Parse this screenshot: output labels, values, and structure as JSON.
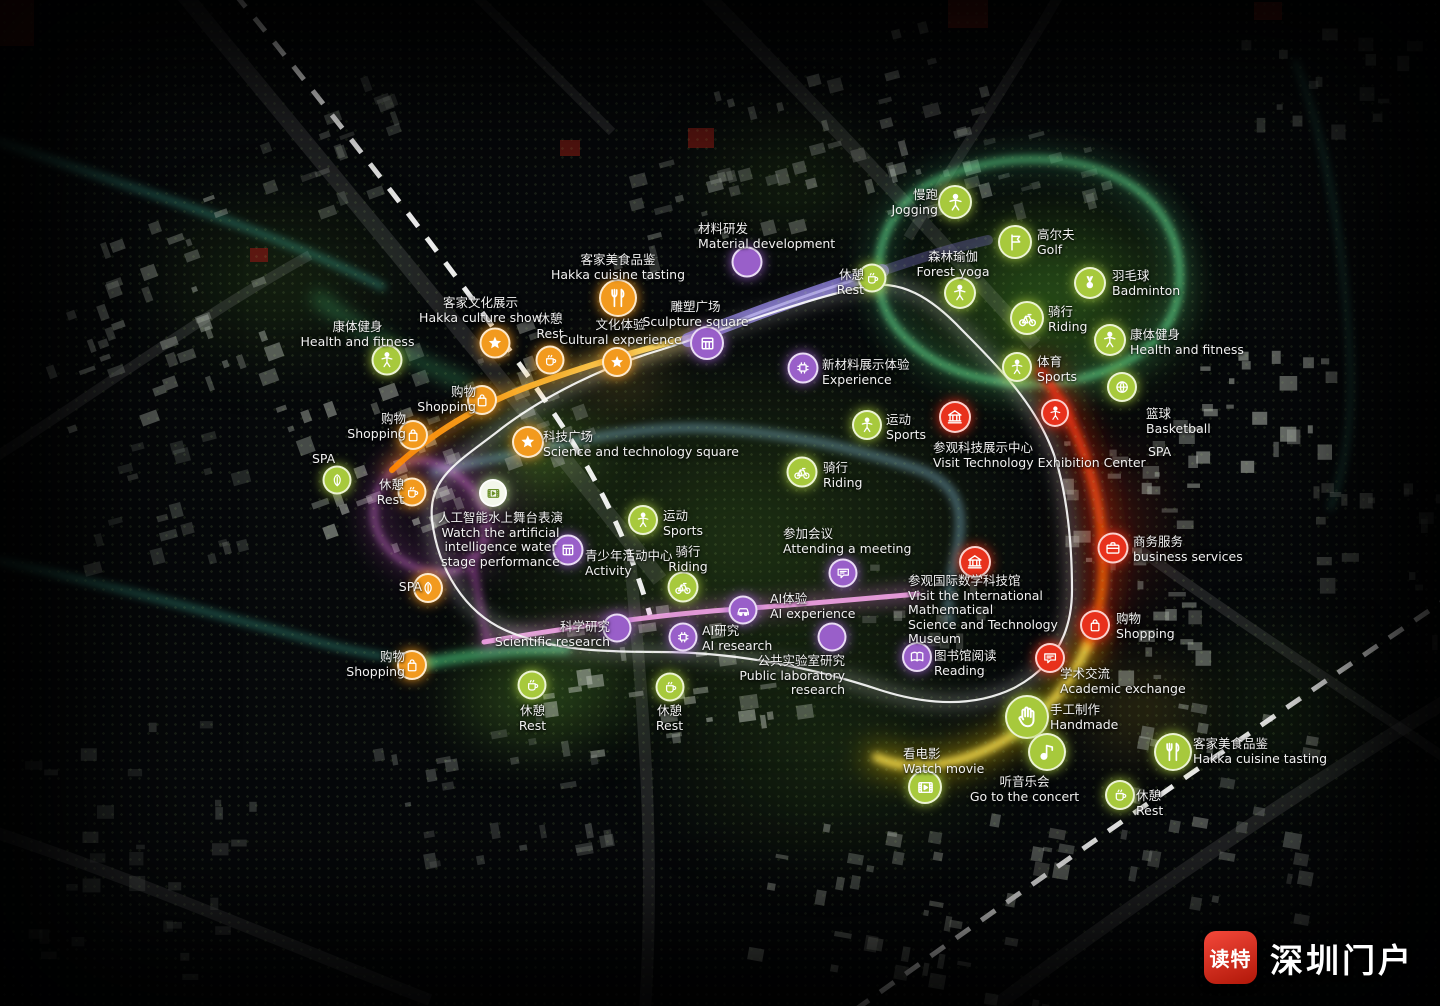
{
  "watermark": {
    "app_name": "读特",
    "site_name": "深圳门户"
  },
  "colors": {
    "green": "#a7c93c",
    "orange": "#f29a1e",
    "purple": "#995fc9",
    "red": "#e8311c",
    "white": "#f3f7ea"
  },
  "points": [
    {
      "name": "jogging",
      "zh": "慢跑",
      "en": "Jogging",
      "icon": "person",
      "c": "g",
      "x": 955,
      "y": 202,
      "s": 30,
      "lx": 862,
      "ly": 188,
      "lw": 76,
      "ta": "right"
    },
    {
      "name": "golf",
      "zh": "高尔夫",
      "en": "Golf",
      "icon": "flag",
      "c": "g",
      "x": 1015,
      "y": 242,
      "s": 30,
      "lx": 1037,
      "ly": 228,
      "lw": 90,
      "ta": "left"
    },
    {
      "name": "forest-yoga",
      "zh": "森林瑜伽",
      "en": "Forest yoga",
      "icon": "person",
      "c": "g",
      "x": 960,
      "y": 293,
      "s": 28,
      "lx": 898,
      "ly": 250,
      "lw": 110,
      "ta": "center"
    },
    {
      "name": "badminton",
      "zh": "羽毛球",
      "en": "Badminton",
      "icon": "shuttle",
      "c": "g",
      "x": 1090,
      "y": 283,
      "s": 28,
      "lx": 1112,
      "ly": 269,
      "lw": 95,
      "ta": "left"
    },
    {
      "name": "riding-north",
      "zh": "骑行",
      "en": "Riding",
      "icon": "bike",
      "c": "g",
      "x": 1027,
      "y": 318,
      "s": 30,
      "lx": 1048,
      "ly": 305,
      "lw": 70,
      "ta": "left"
    },
    {
      "name": "health-fitness-east",
      "zh": "康体健身",
      "en": "Health and fitness",
      "icon": "person",
      "c": "g",
      "x": 1110,
      "y": 340,
      "s": 28,
      "lx": 1130,
      "ly": 328,
      "lw": 125,
      "ta": "left"
    },
    {
      "name": "sports-east",
      "zh": "体育",
      "en": "Sports",
      "icon": "person",
      "c": "g",
      "x": 1017,
      "y": 367,
      "s": 26,
      "lx": 1037,
      "ly": 355,
      "lw": 60,
      "ta": "left"
    },
    {
      "name": "basketball",
      "zh": "篮球",
      "en": "Basketball",
      "icon": "ball",
      "c": "g",
      "x": 1122,
      "y": 387,
      "s": 26,
      "lx": 1146,
      "ly": 407,
      "lw": 80,
      "ta": "left"
    },
    {
      "name": "spa-east",
      "en": "SPA",
      "c": "g",
      "x": 1157,
      "y": 452,
      "lx": 1148,
      "ly": 445,
      "lw": 45,
      "ta": "left"
    },
    {
      "name": "health-fitness-west",
      "zh": "康体健身",
      "en": "Health and fitness",
      "icon": "person",
      "c": "g",
      "x": 387,
      "y": 360,
      "s": 27,
      "lx": 300,
      "ly": 320,
      "lw": 115,
      "ta": "center"
    },
    {
      "name": "shopping-nw1",
      "zh": "购物",
      "en": "Shopping",
      "icon": "bag",
      "c": "o",
      "x": 482,
      "y": 400,
      "s": 26,
      "lx": 398,
      "ly": 385,
      "lw": 78,
      "ta": "right"
    },
    {
      "name": "shopping-nw2",
      "zh": "购物",
      "en": "Shopping",
      "icon": "bag",
      "c": "o",
      "x": 413,
      "y": 435,
      "s": 26,
      "lx": 328,
      "ly": 412,
      "lw": 78,
      "ta": "right"
    },
    {
      "name": "spa-west",
      "en": "SPA",
      "icon": "leaf",
      "c": "g",
      "x": 337,
      "y": 480,
      "s": 25,
      "lx": 312,
      "ly": 452,
      "lw": 45,
      "ta": "left"
    },
    {
      "name": "rest-west",
      "zh": "休憩",
      "en": "Rest",
      "icon": "cup",
      "c": "o",
      "x": 412,
      "y": 492,
      "s": 25,
      "lx": 352,
      "ly": 478,
      "lw": 52,
      "ta": "right"
    },
    {
      "name": "rest-nw",
      "zh": "休憩",
      "en": "Rest",
      "icon": "cup",
      "c": "o",
      "x": 550,
      "y": 360,
      "s": 25,
      "lx": 524,
      "ly": 312,
      "lw": 52,
      "ta": "center"
    },
    {
      "name": "hakka-cuisine-west",
      "zh": "客家美食品鉴",
      "en": "Hakka cuisine tasting",
      "icon": "fork",
      "c": "o",
      "x": 618,
      "y": 298,
      "s": 34,
      "lx": 518,
      "ly": 253,
      "lw": 200,
      "ta": "center"
    },
    {
      "name": "hakka-culture-show",
      "zh": "客家文化展示",
      "en": "Hakka culture show",
      "icon": "star",
      "c": "o",
      "x": 495,
      "y": 343,
      "s": 27,
      "lx": 398,
      "ly": 296,
      "lw": 165,
      "ta": "center"
    },
    {
      "name": "cultural-experience",
      "zh": "文化体验",
      "en": "Cultural experience",
      "icon": "star",
      "c": "o",
      "x": 617,
      "y": 362,
      "s": 26,
      "lx": 548,
      "ly": 318,
      "lw": 145,
      "ta": "center"
    },
    {
      "name": "sculpture-square",
      "zh": "雕塑广场",
      "en": "Sculpture square",
      "icon": "grid",
      "c": "p",
      "x": 707,
      "y": 343,
      "s": 30,
      "lx": 628,
      "ly": 300,
      "lw": 135,
      "ta": "center"
    },
    {
      "name": "material-development",
      "zh": "材料研发",
      "en": "Material development",
      "icon": "flask",
      "c": "p",
      "x": 747,
      "y": 262,
      "s": 27,
      "lx": 698,
      "ly": 222,
      "lw": 165,
      "ta": "left"
    },
    {
      "name": "rest-north",
      "zh": "休憩",
      "en": "Rest",
      "icon": "cup",
      "c": "g",
      "x": 872,
      "y": 278,
      "s": 25,
      "lx": 812,
      "ly": 268,
      "lw": 52,
      "ta": "right"
    },
    {
      "name": "experience-new-materials",
      "zh": "新材料展示体验",
      "en": "Experience",
      "icon": "chip",
      "c": "p",
      "x": 803,
      "y": 368,
      "s": 27,
      "lx": 822,
      "ly": 358,
      "lw": 130,
      "ta": "left"
    },
    {
      "name": "sports-mid-east",
      "zh": "运动",
      "en": "Sports",
      "icon": "person",
      "c": "g",
      "x": 867,
      "y": 425,
      "s": 26,
      "lx": 886,
      "ly": 413,
      "lw": 60,
      "ta": "left"
    },
    {
      "name": "riding-mid-east",
      "zh": "骑行",
      "en": "Riding",
      "icon": "bike",
      "c": "g",
      "x": 802,
      "y": 472,
      "s": 27,
      "lx": 823,
      "ly": 461,
      "lw": 60,
      "ta": "left"
    },
    {
      "name": "sci-tech-square",
      "zh": "科技广场",
      "en": "Science and technology square",
      "icon": "star",
      "c": "o",
      "x": 528,
      "y": 442,
      "s": 28,
      "lx": 543,
      "ly": 430,
      "lw": 215,
      "ta": "left"
    },
    {
      "name": "visit-tech-exhibition-center",
      "zh": "参观科技展示中心",
      "en": "Visit Technology Exhibition Center",
      "icon": "bank",
      "c": "r",
      "x": 955,
      "y": 417,
      "s": 28,
      "lx": 933,
      "ly": 441,
      "lw": 235,
      "ta": "left"
    },
    {
      "name": "tech-route-stop",
      "icon": "person",
      "c": "r",
      "x": 1055,
      "y": 413,
      "s": 24
    },
    {
      "name": "ai-water-stage-show",
      "zh": "人工智能水上舞台表演",
      "en": "Watch the artificial intelligence water",
      "en2": "stage performance",
      "icon": "film",
      "c": "wh",
      "x": 493,
      "y": 493,
      "s": 24,
      "lx": 408,
      "ly": 511,
      "lw": 185,
      "ta": "center"
    },
    {
      "name": "youth-activity-center",
      "zh": "青少年活动中心",
      "en": "Activity",
      "icon": "grid",
      "c": "p",
      "x": 568,
      "y": 550,
      "s": 27,
      "lx": 585,
      "ly": 549,
      "lw": 130,
      "ta": "left"
    },
    {
      "name": "sports-center",
      "zh": "运动",
      "en": "Sports",
      "icon": "person",
      "c": "g",
      "x": 643,
      "y": 520,
      "s": 26,
      "lx": 663,
      "ly": 509,
      "lw": 60,
      "ta": "left"
    },
    {
      "name": "riding-center",
      "zh": "骑行",
      "en": "Riding",
      "icon": "bike",
      "c": "g",
      "x": 683,
      "y": 587,
      "s": 27,
      "lx": 658,
      "ly": 545,
      "lw": 60,
      "ta": "center"
    },
    {
      "name": "attending-a-meeting",
      "zh": "参加会议",
      "en": "Attending a meeting",
      "icon": "bubble",
      "c": "p",
      "x": 843,
      "y": 573,
      "s": 25,
      "lx": 783,
      "ly": 527,
      "lw": 140,
      "ta": "left"
    },
    {
      "name": "math-science-museum",
      "zh": "参观国际数学科技馆",
      "en": "Visit the International Mathematical",
      "en2": "Science and Technology Museum",
      "icon": "bank",
      "c": "r",
      "x": 975,
      "y": 562,
      "s": 28,
      "lx": 908,
      "ly": 574,
      "lw": 190,
      "ta": "left"
    },
    {
      "name": "scientific-research",
      "zh": "科学研究",
      "en": "Scientific research",
      "icon": "flask",
      "c": "p",
      "x": 617,
      "y": 628,
      "s": 25,
      "lx": 480,
      "ly": 620,
      "lw": 130,
      "ta": "right"
    },
    {
      "name": "ai-experience",
      "zh": "AI体验",
      "en": "AI experience",
      "icon": "car",
      "c": "p",
      "x": 743,
      "y": 610,
      "s": 25,
      "lx": 770,
      "ly": 592,
      "lw": 100,
      "ta": "left"
    },
    {
      "name": "ai-research",
      "zh": "AI研究",
      "en": "AI research",
      "icon": "chip",
      "c": "p",
      "x": 683,
      "y": 637,
      "s": 25,
      "lx": 702,
      "ly": 624,
      "lw": 85,
      "ta": "left"
    },
    {
      "name": "public-laboratory-research",
      "zh": "公共实验室研究",
      "en": "Public laboratory research",
      "icon": "flask",
      "c": "p",
      "x": 832,
      "y": 637,
      "s": 25,
      "lx": 700,
      "ly": 654,
      "lw": 145,
      "ta": "right"
    },
    {
      "name": "library-reading",
      "zh": "图书馆阅读",
      "en": "Reading",
      "icon": "book",
      "c": "p",
      "x": 917,
      "y": 657,
      "s": 26,
      "lx": 934,
      "ly": 649,
      "lw": 100,
      "ta": "left"
    },
    {
      "name": "academic-exchange",
      "zh": "学术交流",
      "en": "Academic exchange",
      "icon": "bubble",
      "c": "r",
      "x": 1050,
      "y": 658,
      "s": 26,
      "lx": 1060,
      "ly": 667,
      "lw": 130,
      "ta": "left"
    },
    {
      "name": "business-services",
      "zh": "商务服务",
      "en": "business services",
      "icon": "case",
      "c": "r",
      "x": 1113,
      "y": 548,
      "s": 27,
      "lx": 1133,
      "ly": 535,
      "lw": 125,
      "ta": "left"
    },
    {
      "name": "shopping-east",
      "zh": "购物",
      "en": "Shopping",
      "icon": "bag",
      "c": "r",
      "x": 1095,
      "y": 625,
      "s": 26,
      "lx": 1116,
      "ly": 612,
      "lw": 70,
      "ta": "left"
    },
    {
      "name": "handmade",
      "zh": "手工制作",
      "en": "Handmade",
      "icon": "hand",
      "c": "g",
      "x": 1027,
      "y": 717,
      "s": 40,
      "lx": 1050,
      "ly": 703,
      "lw": 95,
      "ta": "left"
    },
    {
      "name": "watch-movie",
      "zh": "看电影",
      "en": "Watch movie",
      "icon": "film",
      "c": "g",
      "x": 925,
      "y": 787,
      "s": 30,
      "lx": 903,
      "ly": 747,
      "lw": 95,
      "ta": "left"
    },
    {
      "name": "go-to-the-concert",
      "zh": "听音乐会",
      "en": "Go to the concert",
      "icon": "note",
      "c": "g",
      "x": 1047,
      "y": 752,
      "s": 34,
      "lx": 962,
      "ly": 775,
      "lw": 125,
      "ta": "center"
    },
    {
      "name": "rest-southeast",
      "zh": "休憩",
      "en": "Rest",
      "icon": "cup",
      "c": "g",
      "x": 1120,
      "y": 795,
      "s": 26,
      "lx": 1136,
      "ly": 789,
      "lw": 50,
      "ta": "left"
    },
    {
      "name": "hakka-cuisine-east",
      "zh": "客家美食品鉴",
      "en": "Hakka cuisine tasting",
      "icon": "fork",
      "c": "g",
      "x": 1173,
      "y": 752,
      "s": 34,
      "lx": 1193,
      "ly": 737,
      "lw": 150,
      "ta": "left"
    },
    {
      "name": "rest-south-1",
      "zh": "休憩",
      "en": "Rest",
      "icon": "cup",
      "c": "g",
      "x": 532,
      "y": 685,
      "s": 25,
      "lx": 505,
      "ly": 704,
      "lw": 55,
      "ta": "center"
    },
    {
      "name": "rest-south-2",
      "zh": "休憩",
      "en": "Rest",
      "icon": "cup",
      "c": "g",
      "x": 670,
      "y": 687,
      "s": 25,
      "lx": 642,
      "ly": 704,
      "lw": 55,
      "ta": "center"
    },
    {
      "name": "spa-south",
      "en": "SPA",
      "icon": "leaf",
      "c": "o",
      "x": 428,
      "y": 588,
      "s": 26,
      "lx": 378,
      "ly": 580,
      "lw": 44,
      "ta": "right"
    },
    {
      "name": "shopping-southwest",
      "zh": "购物",
      "en": "Shopping",
      "icon": "bag",
      "c": "o",
      "x": 412,
      "y": 665,
      "s": 26,
      "lx": 330,
      "ly": 650,
      "lw": 75,
      "ta": "right"
    }
  ]
}
